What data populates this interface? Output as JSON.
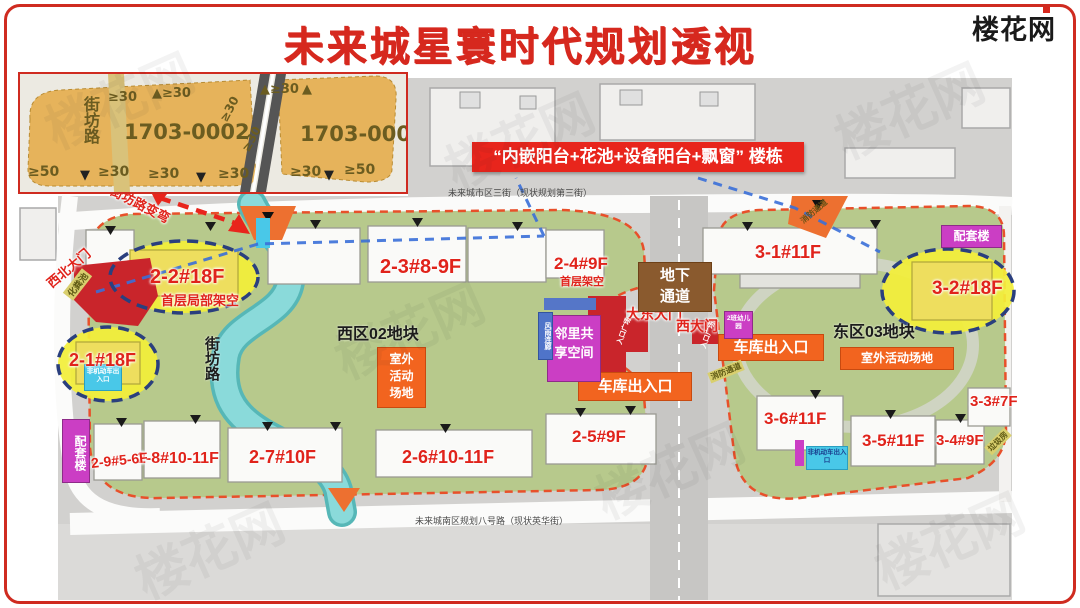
{
  "title": "未来城星寰时代规划透视",
  "logo": "楼花网",
  "banner": "“内嵌阳台+花池+设备阳台+飘窗” 楼栋",
  "inset": {
    "street": "街坊路",
    "parcel_left": "1703-0002",
    "parcel_right": "1703-0003",
    "top_labels": [
      "≥30",
      "▲≥30",
      "≥30",
      "≥30",
      "▲≥30",
      "▲"
    ],
    "bottom_labels": [
      "≥50",
      "▼",
      "≥30",
      "≥30",
      "▼",
      "≥30",
      "≥30",
      "▼",
      "≥50"
    ]
  },
  "map": {
    "parcel_west": "西区02地块",
    "parcel_east": "东区03地块",
    "street_vertical": "街坊路",
    "road_top": "未来城市区三街（现状规划第三街）",
    "road_bottom": "未来城南区规划八号路（现状英华街）",
    "street_change_note": "街坊路变弯",
    "underground_passage": "地下通道",
    "gate_northwest": "西北大门",
    "gate_east_main": "大东大门",
    "gate_west": "西大门",
    "entry_plaza": "入口广场",
    "septic_tank": "化粪池",
    "fire_lane": "消防通道",
    "garbage_room": "垃圾房",
    "rain_corridor": "风雨连廊",
    "garage_entrance": "车库出入口",
    "outdoor_area": "室外活动场地",
    "outdoor_area_lines": [
      "室外",
      "活动",
      "场地"
    ],
    "shared_space_lines": [
      "邻里共",
      "享空间"
    ],
    "support_building": "配套楼",
    "kindergarten": "2班幼儿园",
    "nonmotor_entrance": "非机动车出入口"
  },
  "buildings": {
    "b21": {
      "label": "2-1#18F"
    },
    "b22": {
      "label": "2-2#18F",
      "note": "首层局部架空"
    },
    "b23": {
      "label": "2-3#8-9F"
    },
    "b24": {
      "label": "2-4#9F",
      "note": "首层架空"
    },
    "b25": {
      "label": "2-5#9F"
    },
    "b26": {
      "label": "2-6#10-11F"
    },
    "b27": {
      "label": "2-7#10F"
    },
    "b28": {
      "label": "2-8#10-11F"
    },
    "b29": {
      "label": "2-9#5-6F"
    },
    "b31": {
      "label": "3-1#11F"
    },
    "b32": {
      "label": "3-2#18F"
    },
    "b33": {
      "label": "3-3#7F"
    },
    "b34": {
      "label": "3-4#9F"
    },
    "b35": {
      "label": "3-5#11F"
    },
    "b36": {
      "label": "3-6#11F"
    }
  },
  "colors": {
    "accent_red": "#e8251c",
    "parcel_green": "#b7c98c",
    "highlight_yellow": "#f3ef39",
    "river_teal": "#7ecfcf",
    "facility_magenta": "#cb3ec4",
    "facility_orange": "#f2641f"
  }
}
